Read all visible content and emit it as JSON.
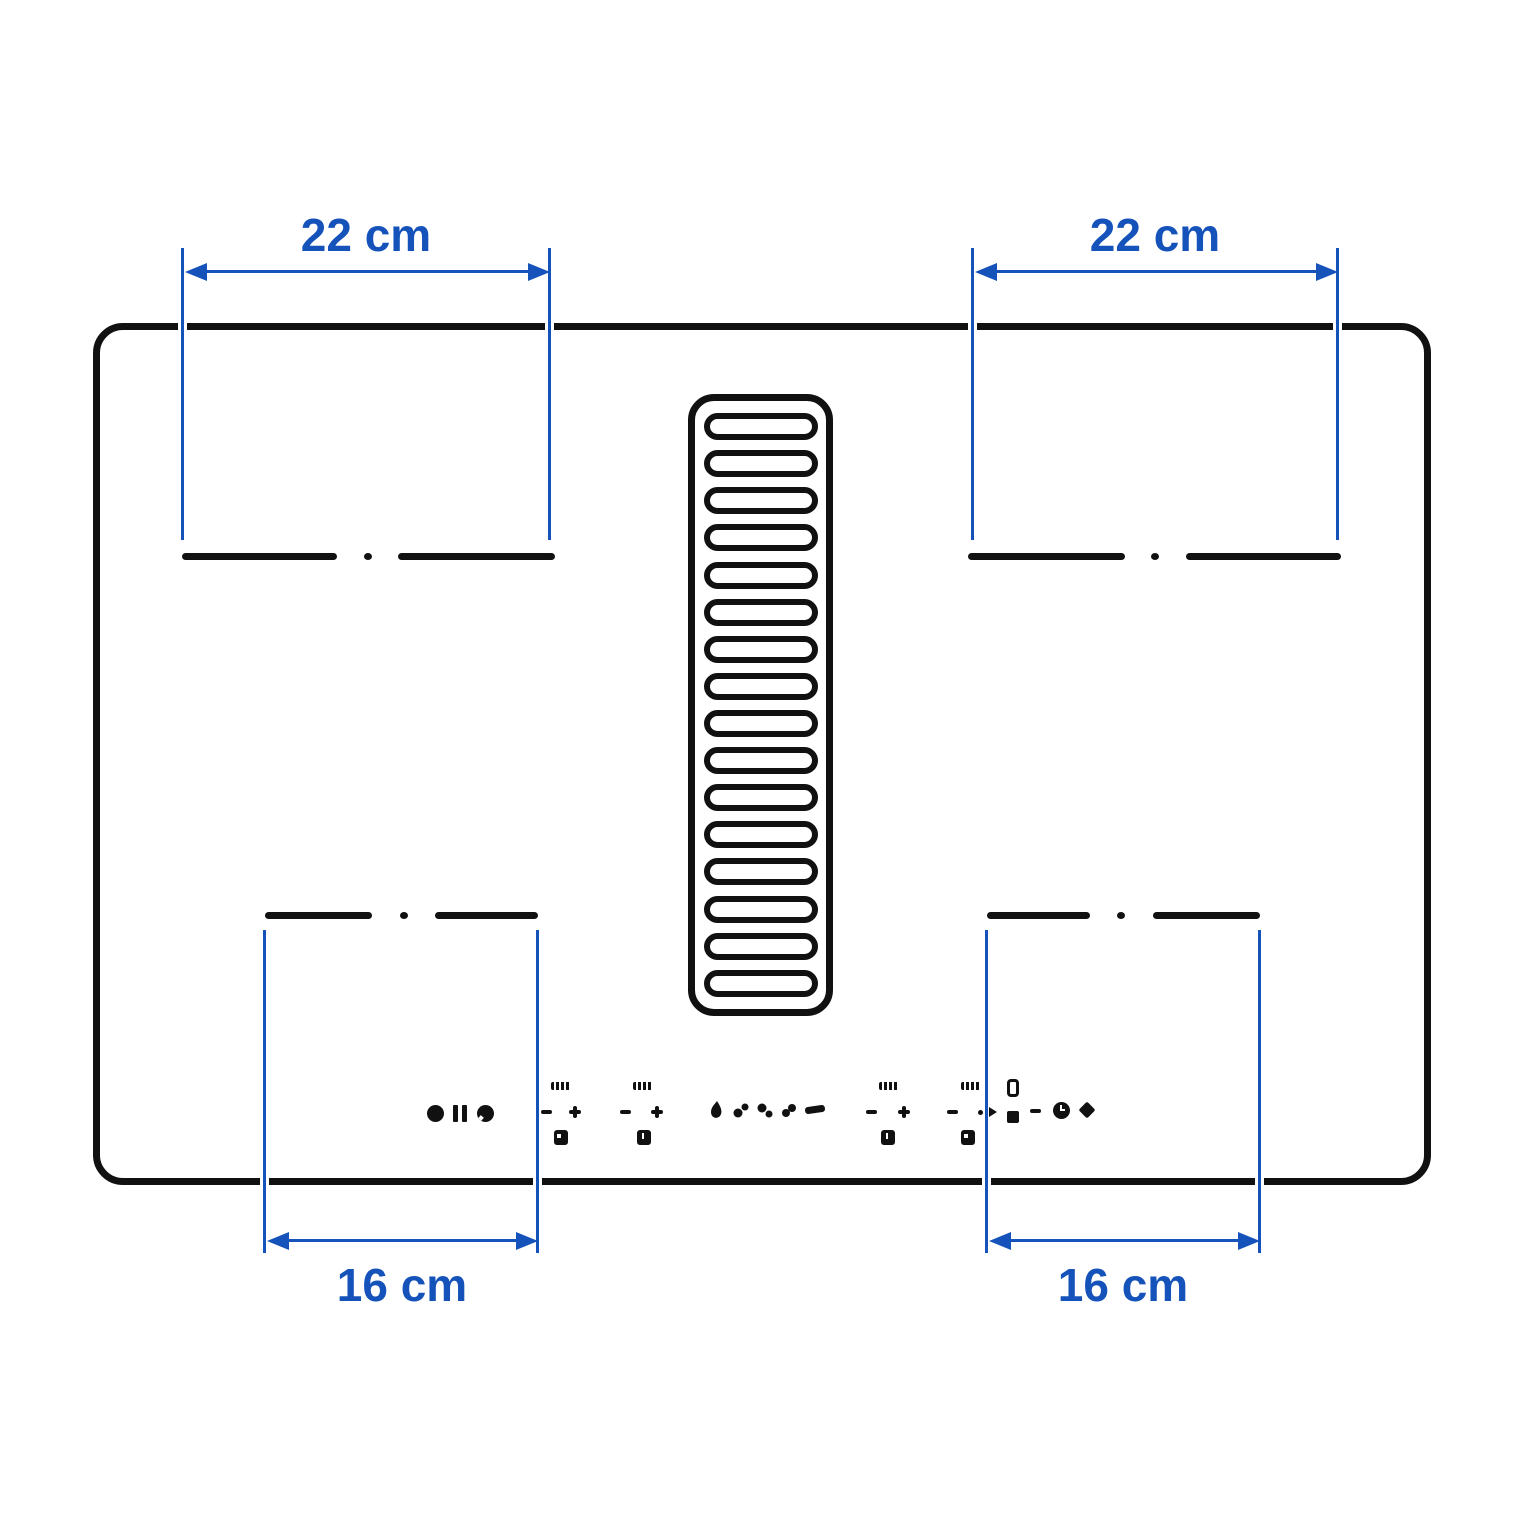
{
  "title": "Hob with integrated extractor — cooking zone dimension diagram",
  "dimension_labels": {
    "top_left": "22 cm",
    "top_right": "22 cm",
    "bottom_left": "16 cm",
    "bottom_right": "16 cm"
  },
  "colors": {
    "dimension_blue": "#1553BA",
    "outline_black": "#111111",
    "background": "#FFFFFF"
  },
  "grille": {
    "slat_count": 16
  },
  "icons": [
    "power-dot-icon",
    "pause-icon",
    "power-icon",
    "zone-display",
    "minus-button",
    "plus-button",
    "zone-indicator-square",
    "fan-speed-icons",
    "fan-bar-icon",
    "timer-display",
    "timer-square",
    "timer-minus",
    "clock-icon",
    "key-diamond-icon"
  ]
}
